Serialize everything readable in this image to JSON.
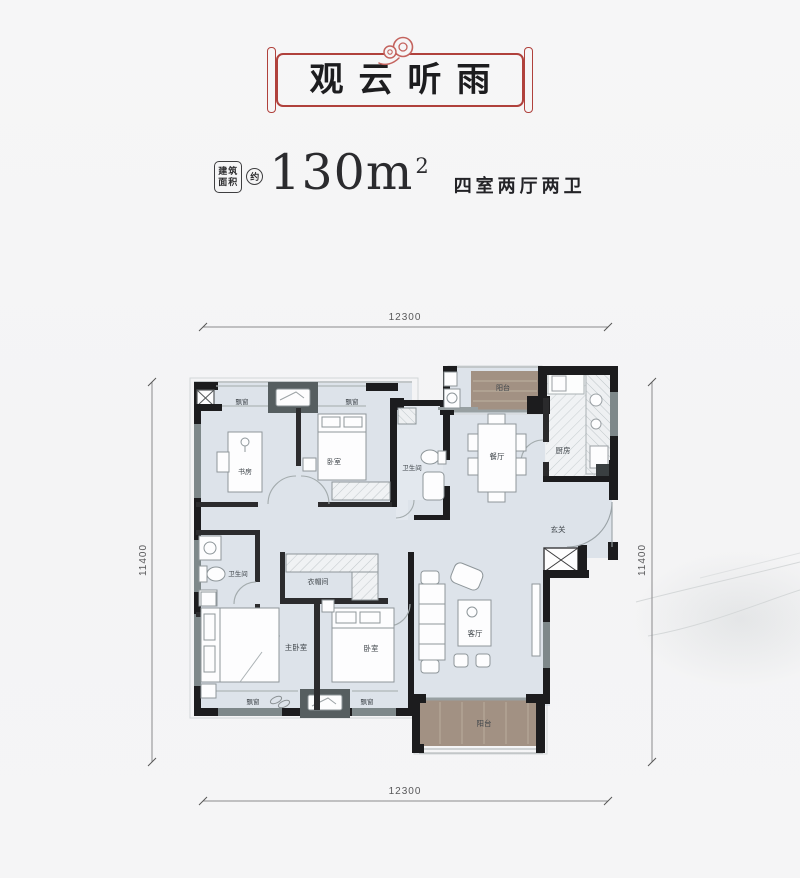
{
  "header": {
    "title": "观云听雨",
    "ornament": "auspicious-cloud",
    "frame_color": "#b0413c"
  },
  "area": {
    "badge_line1": "建筑",
    "badge_line2": "面积",
    "approx": "约",
    "value": "130m",
    "sup": "2",
    "layout": "四室两厅两卫"
  },
  "dimensions": {
    "top": "12300",
    "bottom": "12300",
    "left": "11400",
    "right": "11400"
  },
  "rooms": [
    {
      "label": "飘窗"
    },
    {
      "label": "飘窗"
    },
    {
      "label": "书房"
    },
    {
      "label": "卧室"
    },
    {
      "label": "卫生间"
    },
    {
      "label": "餐厅"
    },
    {
      "label": "厨房"
    },
    {
      "label": "阳台"
    },
    {
      "label": "玄关"
    },
    {
      "label": "卫生间"
    },
    {
      "label": "衣帽间"
    },
    {
      "label": "主卧室"
    },
    {
      "label": "卧室"
    },
    {
      "label": "客厅"
    },
    {
      "label": "阳台"
    },
    {
      "label": "飘窗"
    },
    {
      "label": "飘窗"
    }
  ],
  "colors": {
    "wall": "#1c1c1e",
    "floor": "#dde3ea",
    "balcony": "#a29183",
    "accent_red": "#b0413c"
  }
}
